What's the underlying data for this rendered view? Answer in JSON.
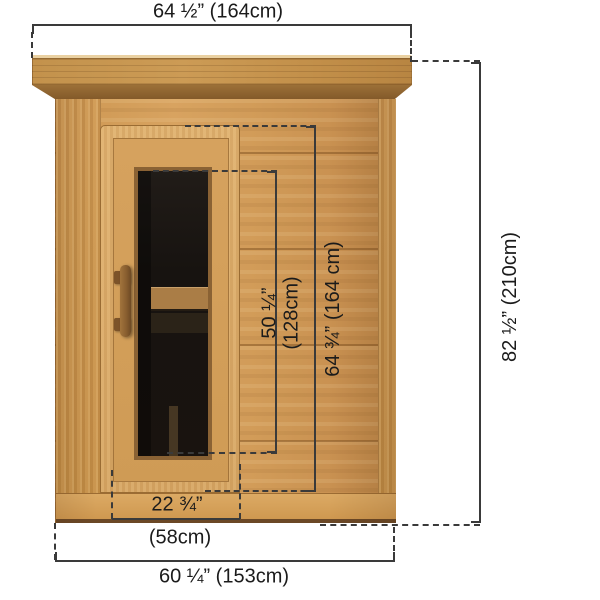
{
  "dimensions": {
    "overall_width": "64 ½” (164cm)",
    "overall_height": "82 ½” (210cm)",
    "window_height_in": "50 ¼”",
    "window_height_cm": "(128cm)",
    "door_height": "64 ¾” (164 cm)",
    "door_width_in": "22 ¾”",
    "door_width_cm": "(58cm)",
    "base_width": "60 ¼” (153cm)"
  },
  "colors": {
    "background": "#ffffff",
    "line": "#3a3a3a",
    "text": "#1b1b1b",
    "wood-body": "#d19b58",
    "wood-crown-highlight": "#ead1a2",
    "wood-bevel": "#9c7038",
    "wood-door": "#dfb06e",
    "wood-door-slab": "#d6a25e",
    "glass": "#171310",
    "bench": "#aa7d46",
    "sill-edge": "#6b4826"
  }
}
